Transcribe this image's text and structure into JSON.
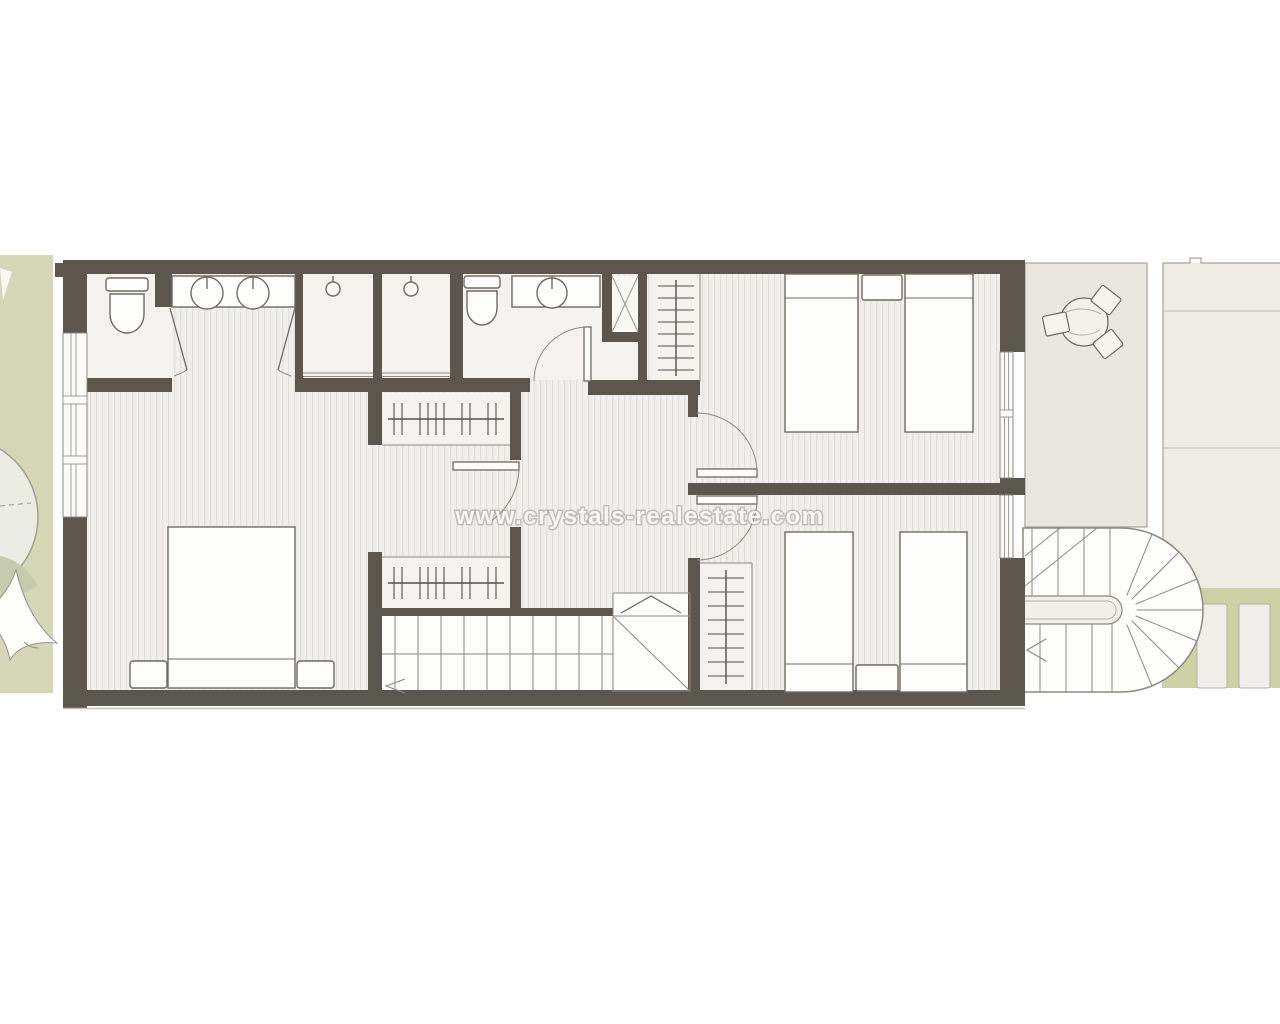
{
  "watermark": {
    "text": "www.crystals-realestate.com"
  },
  "plan": {
    "type": "apartment-floor-plan",
    "rooms": [
      "bathroom-1",
      "shower-cubicles",
      "bathroom-2",
      "shower-room",
      "built-in-wardrobes",
      "master-bedroom",
      "hallway",
      "bedroom-2",
      "bedroom-3",
      "staircase",
      "terrace",
      "garden-strip-left",
      "paved-side-passage",
      "exterior-curved-staircase"
    ],
    "fixtures": [
      "toilet",
      "double-sink-vanity",
      "single-sink-vanity",
      "shower-head",
      "shower-tray-x",
      "wardrobe-rail-with-hangers",
      "double-bed",
      "single-bed",
      "nightstand",
      "round-table",
      "chair",
      "stair-treads",
      "up-arrow",
      "stepping-stones",
      "tree-canopy",
      "shade-sail"
    ],
    "colors": {
      "wall": "#5d564d",
      "floor_stripe_base": "#f0efeb",
      "floor_stripe_line": "#e2e1dc",
      "wet_room_floor": "#f4f3ef",
      "terrace": "#eae7e0",
      "paving": "#eeece5",
      "garden_left": "#d5d7b6",
      "garden_right": "#ccd1a6",
      "outline": "#8d897f",
      "fixture_outline": "#6f6a62",
      "watermark_text": "#ffffff"
    }
  }
}
